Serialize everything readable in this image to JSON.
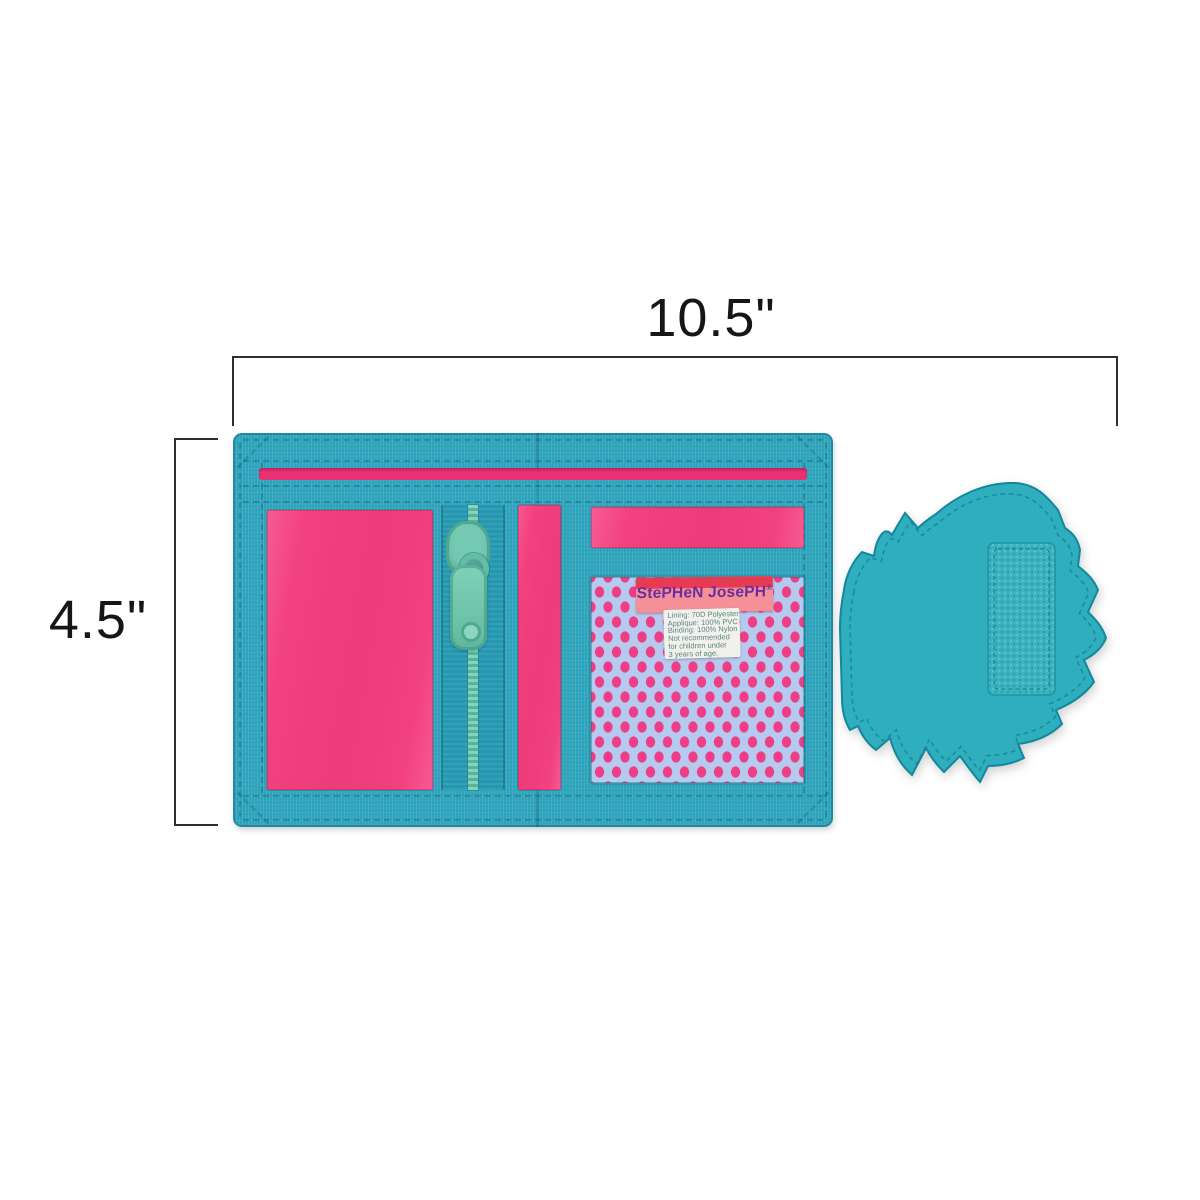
{
  "dimensions": {
    "width_label": "10.5\"",
    "height_label": "4.5\""
  },
  "wallet": {
    "brand_tag": {
      "text": "StePHeN JosePH",
      "registered_mark": "®"
    },
    "care_label": {
      "lines": [
        "Lining: 70D Polyester",
        "Applique: 100% PVC",
        "Binding: 100% Nylon",
        "Not recommended",
        "for children under",
        "3 years of age."
      ]
    },
    "colors": {
      "binding_teal": "#2ea5bd",
      "zipper_tape_teal": "#2597b0",
      "panel_pink": "#f2417f",
      "bill_slot_pink": "#e93074",
      "mesh_pink": "#ee3f86",
      "mesh_net_lavender": "#b6c9ee",
      "zipper_pull_mint": "#74c9b2",
      "flap_teal": "#2fafbd",
      "tag_salmon": "#f58f98",
      "tag_stripe_red": "#e63b52",
      "tag_text_purple": "#6a2da0",
      "dimension_line": "#2e2e2e"
    }
  }
}
